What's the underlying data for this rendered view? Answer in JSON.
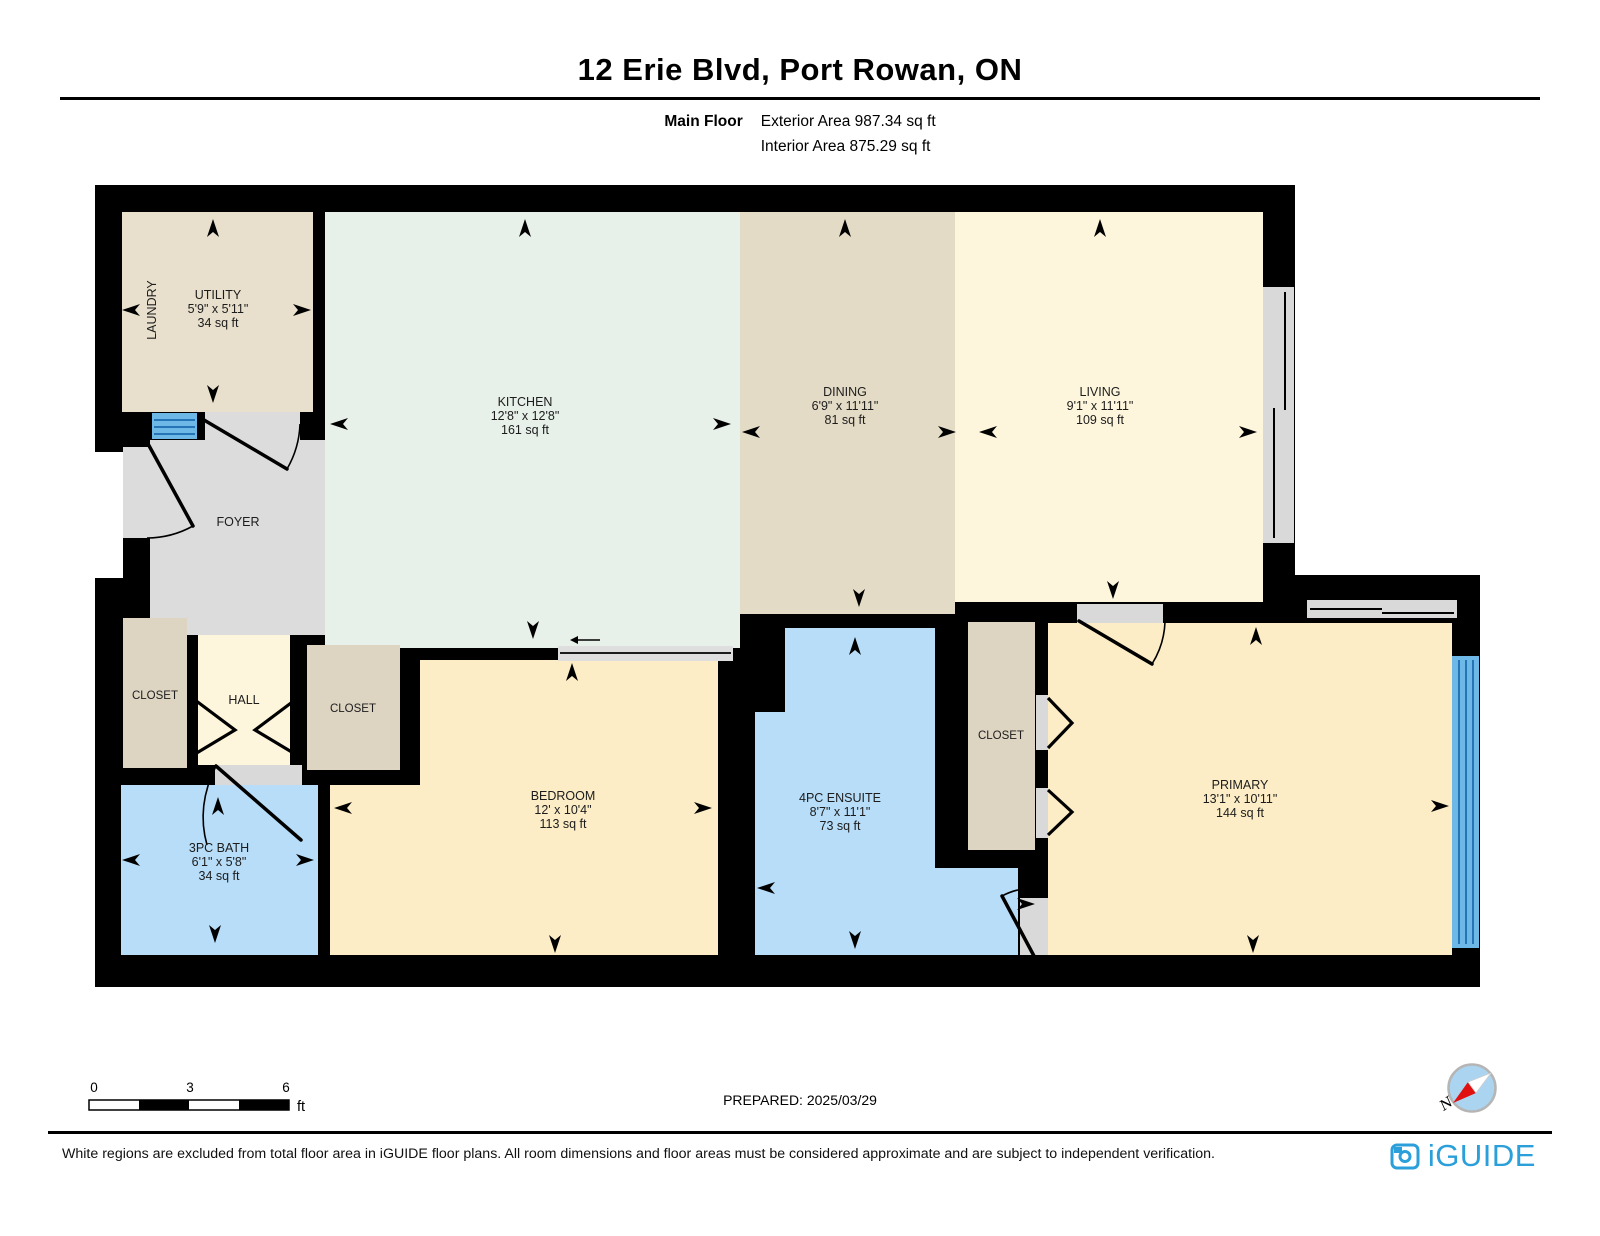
{
  "header": {
    "title": "12 Erie Blvd, Port Rowan, ON",
    "floor_label": "Main Floor",
    "exterior_area": "Exterior Area 987.34 sq ft",
    "interior_area": "Interior Area 875.29 sq ft"
  },
  "rooms": {
    "utility": {
      "name": "UTILITY",
      "dims": "5'9\" x 5'11\"",
      "area": "34 sq ft"
    },
    "laundry": {
      "name": "LAUNDRY"
    },
    "kitchen": {
      "name": "KITCHEN",
      "dims": "12'8\" x 12'8\"",
      "area": "161 sq ft"
    },
    "dining": {
      "name": "DINING",
      "dims": "6'9\" x 11'11\"",
      "area": "81 sq ft"
    },
    "living": {
      "name": "LIVING",
      "dims": "9'1\" x 11'11\"",
      "area": "109 sq ft"
    },
    "foyer": {
      "name": "FOYER"
    },
    "closet_left": {
      "name": "CLOSET"
    },
    "hall": {
      "name": "HALL"
    },
    "closet_bedroom": {
      "name": "CLOSET"
    },
    "bath": {
      "name": "3PC BATH",
      "dims": "6'1\" x 5'8\"",
      "area": "34 sq ft"
    },
    "bedroom": {
      "name": "BEDROOM",
      "dims": "12' x 10'4\"",
      "area": "113 sq ft"
    },
    "ensuite": {
      "name": "4PC ENSUITE",
      "dims": "8'7\" x 11'1\"",
      "area": "73 sq ft"
    },
    "closet_primary": {
      "name": "CLOSET"
    },
    "primary": {
      "name": "PRIMARY",
      "dims": "13'1\" x 10'11\"",
      "area": "144 sq ft"
    }
  },
  "scale_bar": {
    "tick0": "0",
    "tick1": "3",
    "tick2": "6",
    "unit": "ft"
  },
  "prepared_label": "PREPARED: 2025/03/29",
  "compass": {
    "north_label": "N"
  },
  "footer": {
    "disclaimer": "White regions are excluded from total floor area in iGUIDE floor plans. All room dimensions and floor areas must be considered approximate and are subject to independent verification.",
    "brand": "iGUIDE"
  },
  "colors": {
    "wall": "#000000",
    "utility": "#e8e0cc",
    "kitchen": "#e7f0e9",
    "dining": "#e4dbc6",
    "living": "#fdf6dc",
    "foyer": "#dcdcdc",
    "hall": "#fdf6dc",
    "closet": "#ddd4c2",
    "bath": "#b7ddf8",
    "bedroom": "#fcedc6",
    "primary": "#fcedc6",
    "threshold_gray": "#d9d9d9",
    "window_gray": "#d9d9d9",
    "window_blue": "#6db8e7",
    "window_frame": "#2574b5",
    "compass_blue": "#abd4f0",
    "compass_red": "#e01010",
    "brand_blue": "#2b9fd9"
  }
}
